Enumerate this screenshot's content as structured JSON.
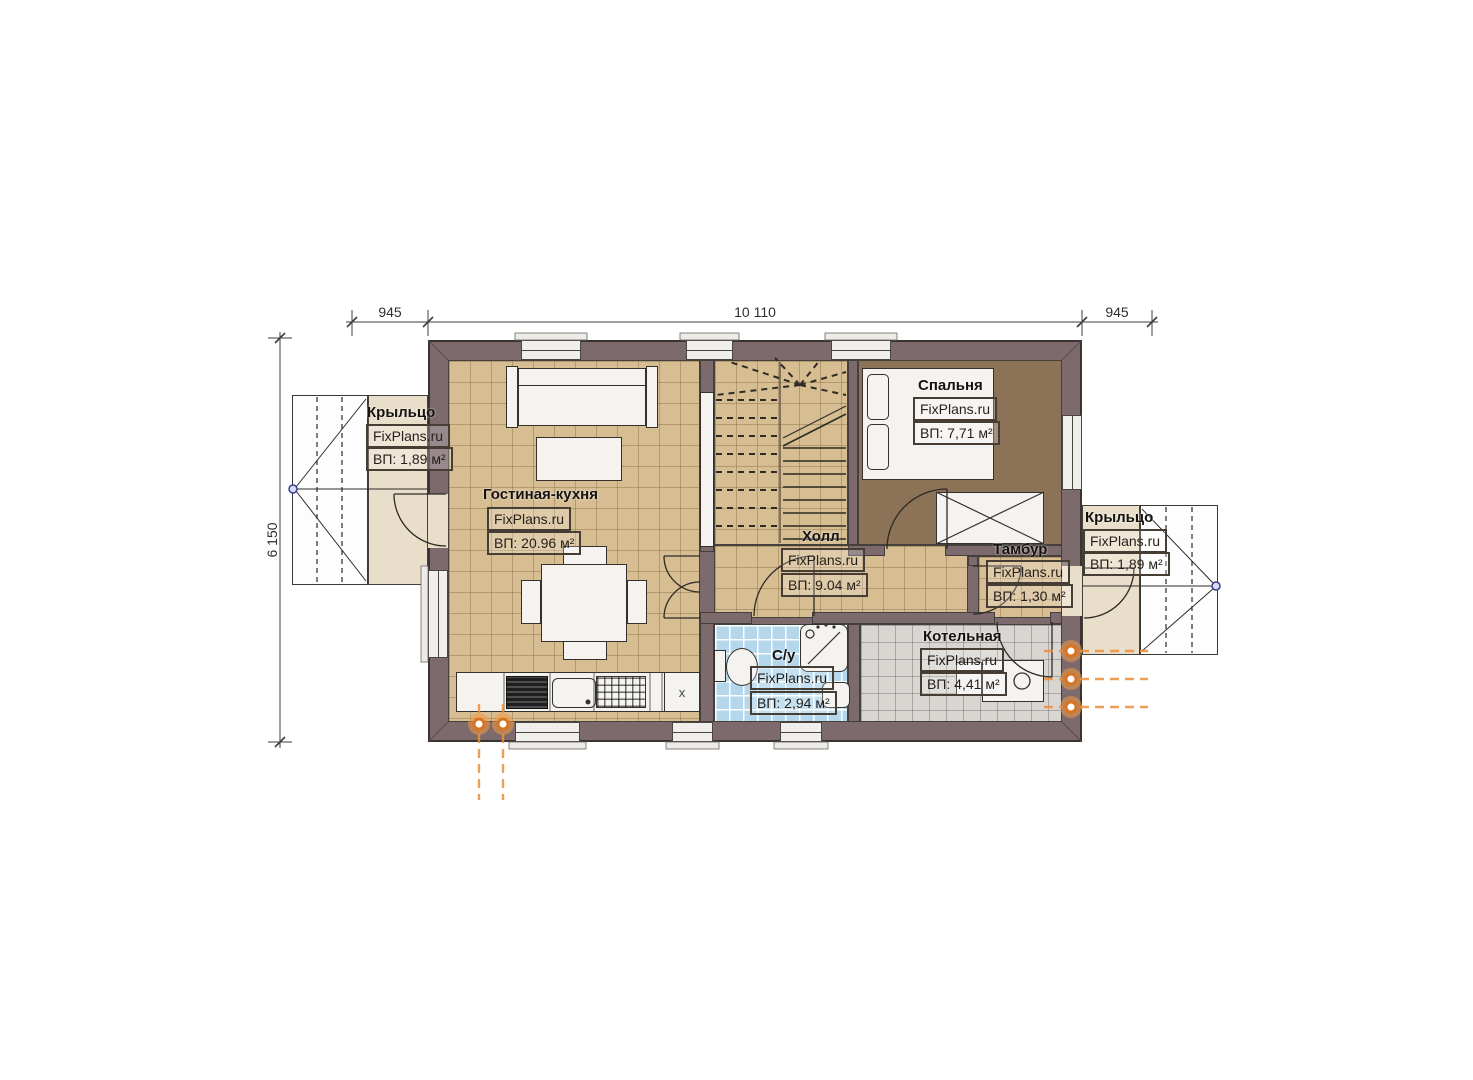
{
  "watermark": "FixPlans.ru",
  "dimensions": {
    "top_left": "945",
    "top_center": "10 110",
    "top_right": "945",
    "left": "6 150"
  },
  "rooms": {
    "porch_left": {
      "name": "Крыльцо",
      "area": "ВП: 1,89 м²"
    },
    "living_kitchen": {
      "name": "Гостиная-кухня",
      "area": "ВП: 20.96 м²"
    },
    "bedroom": {
      "name": "Спальня",
      "area": "ВП: 7,71 м²"
    },
    "hall": {
      "name": "Холл",
      "area": "ВП: 9.04 м²"
    },
    "vestibule": {
      "name": "Тамбур",
      "area": "ВП: 1,30 м²"
    },
    "bathroom": {
      "name": "С/у",
      "area": "ВП: 2,94 м²"
    },
    "boiler": {
      "name": "Котельная",
      "area": "ВП: 4,41 м²"
    },
    "porch_right": {
      "name": "Крыльцо",
      "area": "ВП: 1,89 м²"
    }
  },
  "kitchen": {
    "cabinet_x_label": "x"
  },
  "colors": {
    "wall": "#7c6a6c",
    "floor_living": "#d6bd92",
    "floor_bedroom": "#8c7256",
    "floor_bathroom": "#b4d7ec",
    "floor_boiler": "#d9d6d2",
    "porch": "#e9deca",
    "utility_accent": "#ec8f3a",
    "survey_point": "#3d3d8e"
  }
}
